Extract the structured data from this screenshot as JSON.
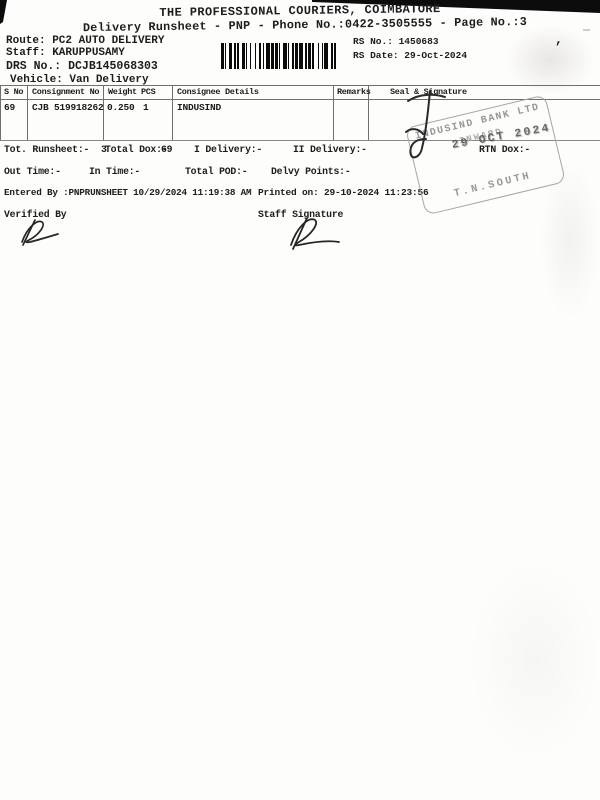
{
  "page": {
    "title": "THE PROFESSIONAL COURIERS, COIMBATORE",
    "subtitle": "Delivery Runsheet - PNP - Phone No.:0422-3505555 - Page No.:3"
  },
  "header": {
    "route": "Route: PC2 AUTO DELIVERY",
    "staff": "Staff: KARUPPUSAMY",
    "drs_no": "DRS No.: DCJB145068303",
    "vehicle": "Vehicle: Van Delivery",
    "rs_no": "RS No.: 1450683",
    "rs_date": "RS Date: 29-Oct-2024",
    "stray_mark": ","
  },
  "table": {
    "columns": [
      "S No",
      "Consignment No",
      "Weight",
      "PCS",
      "Consignee Details",
      "Remarks",
      "Seal & Signature"
    ],
    "rows": [
      {
        "s_no": "69",
        "consignment_no": "CJB 519918262",
        "weight": "0.250",
        "pcs": "1",
        "consignee": "INDUSIND",
        "remarks": ""
      }
    ]
  },
  "summary": {
    "tot_runsheet_label": "Tot. Runsheet:-",
    "tot_runsheet_value": "3",
    "total_dox_label": "Total Dox:-",
    "total_dox_value": "69",
    "i_delivery": "I Delivery:-",
    "ii_delivery": "II Delivery:-",
    "rtn_dox": "RTN Dox:-",
    "out_time": "Out Time:-",
    "in_time": "In Time:-",
    "total_pod": "Total POD:-",
    "delvy_points": "Delvy Points:-"
  },
  "footer": {
    "entered_by": "Entered By :PNPRUNSHEET 10/29/2024 11:19:38 AM",
    "printed_on": "Printed on: 29-10-2024 11:23:56",
    "verified_by": "Verified By",
    "staff_signature": "Staff Signature"
  },
  "stamp": {
    "line1": "INDUSIND BANK LTD",
    "line2": "INWARD",
    "date": "29 OCT 2024",
    "line3": "T.N.SOUTH",
    "ink_color": "#969696",
    "date_color": "#4f4f4f"
  },
  "barcode": {
    "label": "drs-barcode",
    "pattern": "21123121132112131221123121211231122121321121231211322112"
  }
}
